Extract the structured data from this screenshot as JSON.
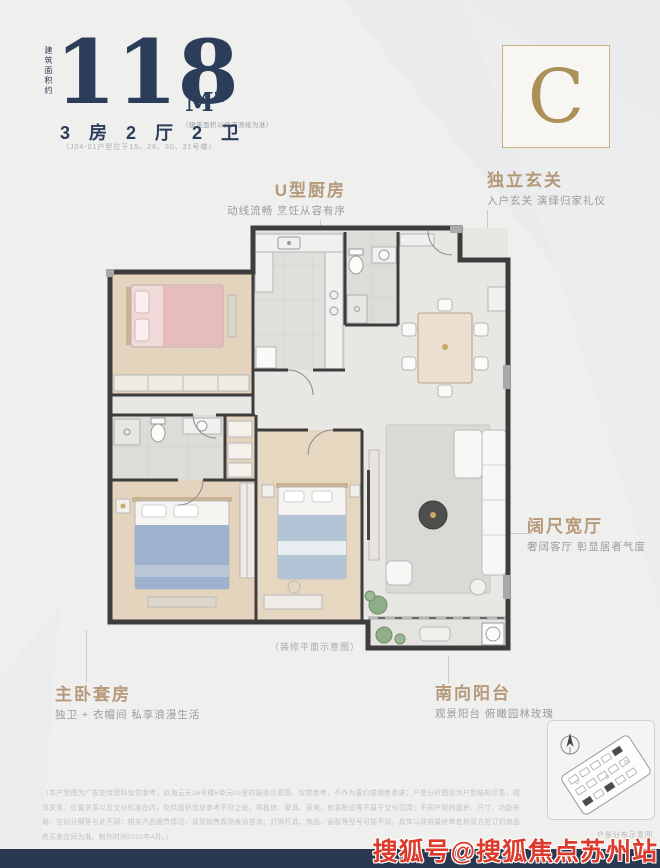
{
  "header": {
    "area_vertical_label": "建筑面积约",
    "area_value": "118",
    "area_unit": "M²",
    "area_note": "（建筑面积以房产测绘为准）",
    "layout": "3 房 2 厅 2 卫",
    "layout_note": "（J04-01户型位于15、26、30、31号楼）",
    "unit_letter": "C"
  },
  "callouts": {
    "kitchen": {
      "title": "U型厨房",
      "subtitle": "动线流畅 烹饪从容有序"
    },
    "foyer": {
      "title": "独立玄关",
      "subtitle": "入户玄关 演绎归家礼仪"
    },
    "living": {
      "title": "阔尺宽厅",
      "subtitle": "奢阔客厅 彰显居者气度"
    },
    "master": {
      "title": "主卧套房",
      "subtitle": "独卫 + 衣帽间 私享浪漫生活"
    },
    "balcony": {
      "title": "南向阳台",
      "subtitle": "观景阳台 俯瞰园林玫瑰"
    }
  },
  "plan": {
    "caption": "（装修平面示意图）"
  },
  "sitemap": {
    "caption": "户型分布示意图"
  },
  "disclaimer": {
    "lines": [
      "（本户型图为广告宣传资料仅供参考，玖海云天26号楼6单元03室的装修示意图，仅供参考，不作为要约或销售承诺；户型分析图仅为户型结构示意，相邻关系、位置关系以及交付标准在",
      "内，仅供面积信息参考不尽之处；样板房、家具、家电、软装陈设等不属于交付范围；不同户型的面积、尺寸、功能布局、空间分隔等与此不同；相关产品细节情况，请到销售现场来访咨",
      "询；灯饰灯具、饰品、画框等型号可能不同，具体以政府最终审批和双方签订的商品房买卖合同为准。制作时间2022年4月。）"
    ]
  },
  "watermark": "搜狐号@搜狐焦点苏州站",
  "colors": {
    "navy": "#2c3d59",
    "gold_title": "#b5997b",
    "gold_border": "#c8b17c",
    "bottom_bar": "#2b3950",
    "watermark_red": "#dc3a2c",
    "wood_floor": "#e4d4bd",
    "tile_floor": "#dcdcd8"
  }
}
